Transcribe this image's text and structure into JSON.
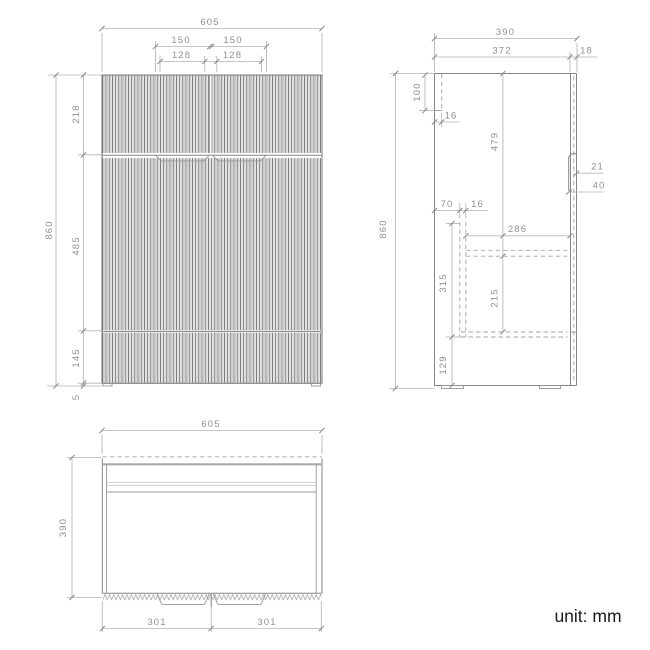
{
  "unit_note": "unit: mm",
  "front_view": {
    "overall_width": "605",
    "handle_span_left": "150",
    "handle_span_right": "150",
    "handle_recess_left": "128",
    "handle_recess_right": "128",
    "overall_height": "860",
    "top_section_height": "218",
    "middle_section_height": "485",
    "bottom_section_height": "145",
    "foot_height": "5"
  },
  "side_view": {
    "overall_depth": "390",
    "carcass_depth": "372",
    "front_thickness": "18",
    "overall_height": "860",
    "back_rail_height": "100",
    "back_rail_thickness": "16",
    "top_to_shelf": "479",
    "handle_groove_depth": "21",
    "handle_groove_height": "40",
    "shelf_back_offset": "70",
    "panel_thickness": "16",
    "shelf_depth": "286",
    "drawer_zone_height": "315",
    "shelf_clearance_height": "215",
    "bottom_zone_height": "129"
  },
  "top_view": {
    "overall_width": "605",
    "overall_depth": "390",
    "door_width_left": "301",
    "door_width_right": "301"
  }
}
